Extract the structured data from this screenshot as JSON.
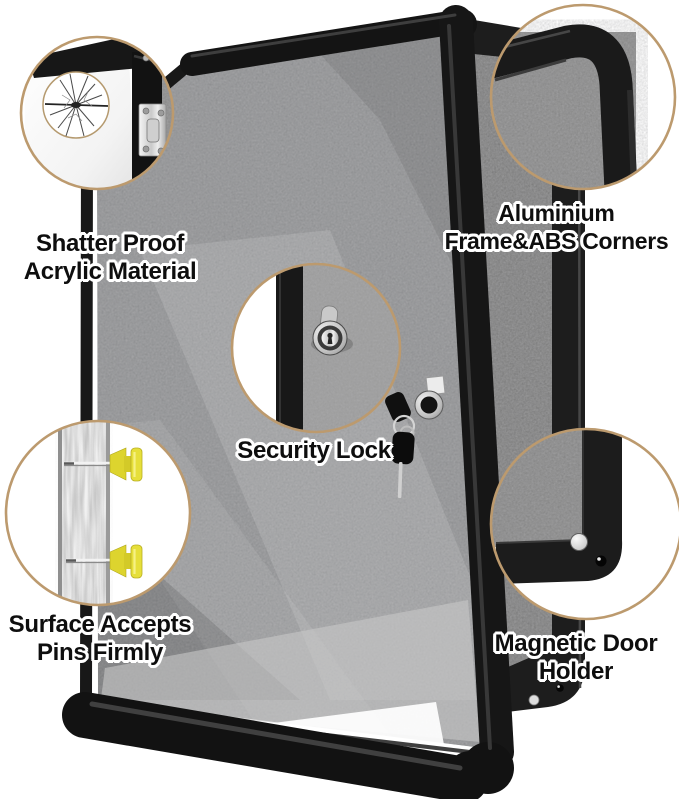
{
  "image_type": "product-feature-callout-diagram",
  "features": [
    {
      "id": "shatterproof",
      "line1": "Shatter Proof",
      "line2": "Acrylic Material"
    },
    {
      "id": "frame",
      "line1": "Aluminium",
      "line2": "Frame&ABS Corners"
    },
    {
      "id": "lock",
      "line1": "Security Lock",
      "line2": ""
    },
    {
      "id": "pins",
      "line1": "Surface Accepts",
      "line2": "Pins Firmly"
    },
    {
      "id": "magnet",
      "line1": "Magnetic Door",
      "line2": "Holder"
    }
  ],
  "callouts": [
    {
      "icon": "cracked-acrylic-icon"
    },
    {
      "icon": "rounded-corner-frame-icon"
    },
    {
      "icon": "cam-lock-icon"
    },
    {
      "icon": "push-pins-icon"
    },
    {
      "icon": "magnet-holder-icon"
    }
  ],
  "colors": {
    "background": "#ffffff",
    "callout_ring": "#bc9a6e",
    "felt_surface": "#8f8f8f",
    "frame_black": "#161616",
    "pin_yellow": "#e6df3a",
    "metal_silver": "#d7d7d7",
    "text": "#0e0e0e",
    "text_halo": "#ffffff"
  }
}
